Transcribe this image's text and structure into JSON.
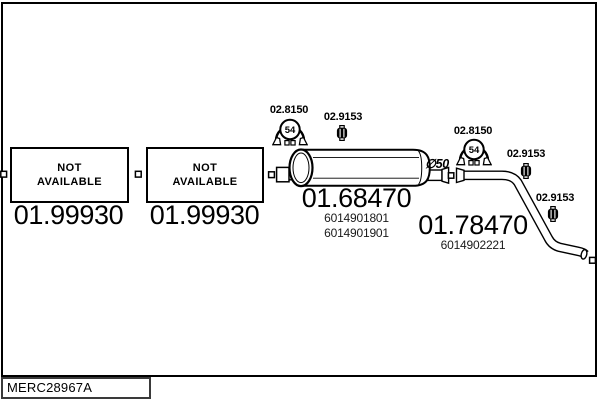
{
  "title_block": {
    "code": "MERC28967A"
  },
  "boxes": [
    {
      "status_line1": "NOT",
      "status_line2": "AVAILABLE",
      "part_number": "01.99930"
    },
    {
      "status_line1": "NOT",
      "status_line2": "AVAILABLE",
      "part_number": "01.99930"
    }
  ],
  "muffler": {
    "part_number": "01.68470",
    "oe_ref1": "6014901801",
    "oe_ref2": "6014901901",
    "diameter_label": "∅50"
  },
  "tail_pipe": {
    "part_number": "01.78470",
    "oe_ref1": "6014902221"
  },
  "clamp": {
    "part_number": "02.8150",
    "badge": "54"
  },
  "hanger": {
    "part_number": "02.9153"
  },
  "colors": {
    "line": "#000000",
    "background": "#ffffff"
  }
}
